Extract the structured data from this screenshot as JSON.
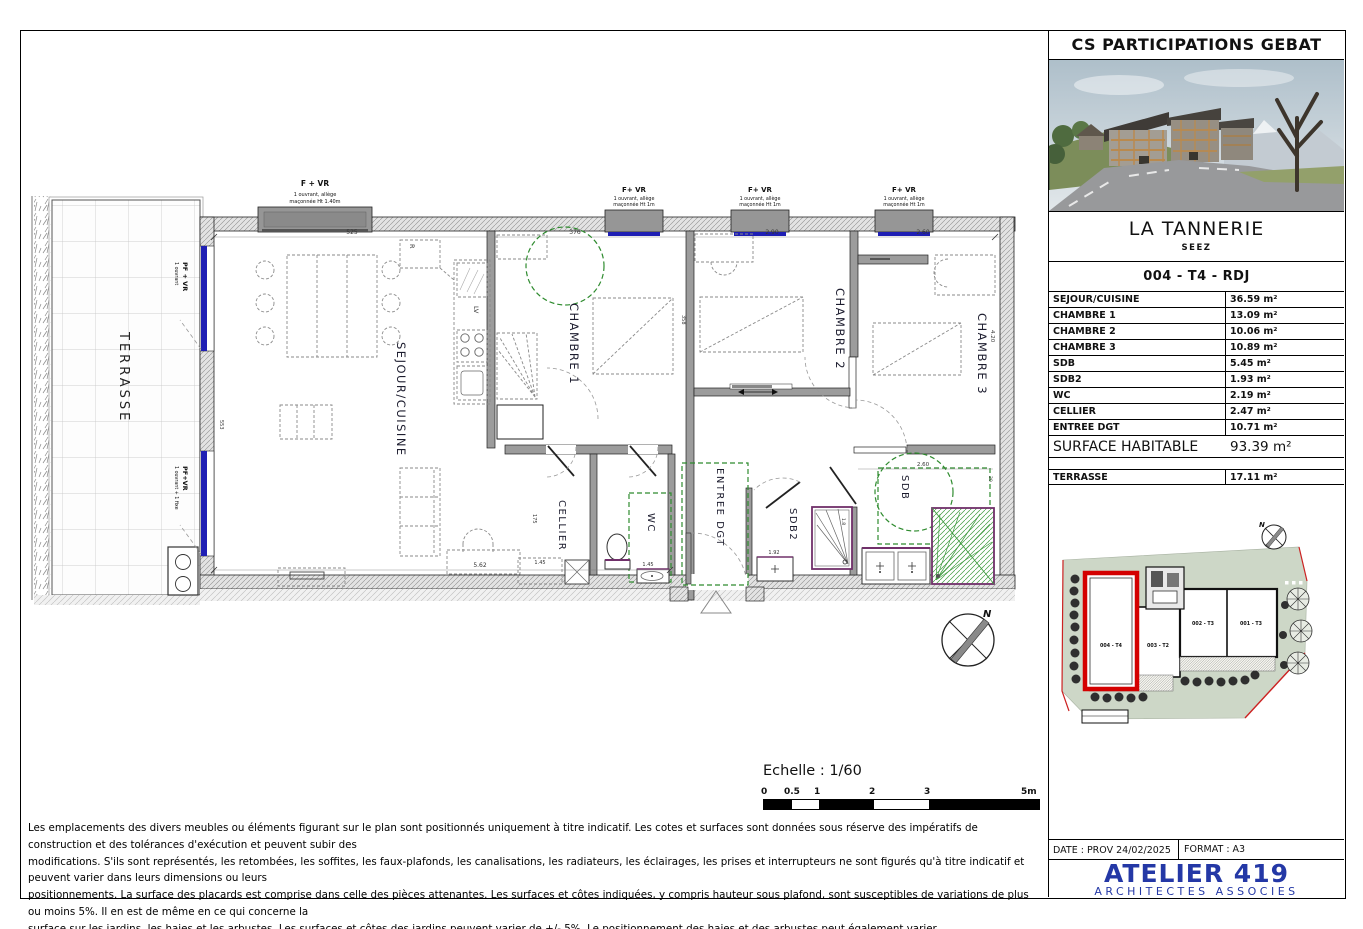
{
  "plan": {
    "rooms": {
      "terrasse": "TERRASSE",
      "sejour": "SEJOUR/CUISINE",
      "chambre1": "CHAMBRE 1",
      "chambre2": "CHAMBRE 2",
      "chambre3": "CHAMBRE 3",
      "cellier": "CELLIER",
      "wc": "WC",
      "entree": "ENTREE DGT",
      "sdb2": "SDB2",
      "sdb": "SDB"
    },
    "kitchen": {
      "fridge": "R",
      "dishwasher": "LV"
    },
    "windows_top": [
      {
        "title": "F + VR",
        "sub1": "1 ouvrant, allège",
        "sub2": "maçonnée Ht 1.40m"
      },
      {
        "title": "F+ VR",
        "sub1": "1 ouvrant, allège",
        "sub2": "maçonnée Ht 1m"
      },
      {
        "title": "F+ VR",
        "sub1": "1 ouvrant, allège",
        "sub2": "maçonnée Ht 1m"
      },
      {
        "title": "F+ VR",
        "sub1": "1 ouvrant, allège",
        "sub2": "maçonnée Ht 1m"
      }
    ],
    "windows_left": [
      {
        "title": "PF + VR",
        "sub": "1 ouvrant"
      },
      {
        "title": "PF+VR",
        "sub": "1 ouvrant + 1 fixe"
      }
    ],
    "dims": {
      "sejour_w": "525",
      "ch1_w": "376",
      "ch2_w": "2.90",
      "ch3_w": "2.60",
      "sejour_b": "5.62",
      "cellier_w": "1.45",
      "wc_w": "1.45",
      "cellier_h": "175",
      "sdb2_w": "1.92",
      "wall_h": "358",
      "terr_h": "553",
      "ch3_h": "4.20",
      "sdb_w": "2.60",
      "sdb_h": "20",
      "shower_w": "1.8"
    },
    "north": "N",
    "scale": {
      "title": "Echelle : 1/60",
      "ticks": [
        "0",
        "0.5",
        "1",
        "2",
        "3",
        "5m"
      ]
    }
  },
  "panel": {
    "company": "CS PARTICIPATIONS GEBAT",
    "project": "LA TANNERIE",
    "city": "SEEZ",
    "unit": "004 - T4 - RDJ",
    "surfaces": [
      {
        "label": "SEJOUR/CUISINE",
        "value": "36.59 m²"
      },
      {
        "label": "CHAMBRE 1",
        "value": "13.09 m²"
      },
      {
        "label": "CHAMBRE 2",
        "value": "10.06 m²"
      },
      {
        "label": "CHAMBRE 3",
        "value": "10.89 m²"
      },
      {
        "label": "SDB",
        "value": "5.45 m²"
      },
      {
        "label": "SDB2",
        "value": "1.93 m²"
      },
      {
        "label": "WC",
        "value": "2.19 m²"
      },
      {
        "label": "CELLIER",
        "value": "2.47 m²"
      },
      {
        "label": "ENTREE DGT",
        "value": "10.71 m²"
      }
    ],
    "total": {
      "label": "SURFACE HABITABLE",
      "value": "93.39 m²"
    },
    "terrasse_row": {
      "label": "TERRASSE",
      "value": "17.11 m²"
    },
    "site": {
      "units": [
        "004 - T4",
        "003 - T2",
        "002 - T3",
        "001 - T3"
      ],
      "north": "N"
    },
    "date_label": "DATE : PROV 24/02/2025",
    "format_label": "FORMAT : A3",
    "firm": "ATELIER 419",
    "firm_sub": "ARCHITECTES ASSOCIES"
  },
  "disclaimer": {
    "lines": [
      "Les emplacements des divers meubles ou éléments figurant sur le plan sont positionnés uniquement à titre indicatif. Les cotes et surfaces sont données sous réserve des impératifs de construction et des tolérances d'exécution et peuvent subir des",
      "modifications. S'ils sont représentés, les retombées, les soffites, les faux-plafonds, les canalisations, les radiateurs, les éclairages, les prises et interrupteurs ne sont figurés qu'à titre indicatif et peuvent varier dans leurs dimensions ou leurs",
      "positionnements. La surface des placards est comprise dans celle des pièces attenantes. Les surfaces et côtes indiquées, y compris hauteur sous plafond, sont susceptibles de variations de plus ou moins 5%. Il en est de même en ce qui concerne la",
      "surface sur les jardins, les haies et les arbustes. Les surfaces et côtes des jardins peuvent varier de +/- 5%. Le positionnement des haies et des arbustes peut également varier."
    ]
  },
  "colors": {
    "window_blue": "#1f1fb4",
    "plan_green": "#2e8b2e",
    "fixture_purple": "#70306a",
    "site_green": "#cdd7c7",
    "unit_red": "#d40000",
    "firm_blue": "#2438a6"
  }
}
